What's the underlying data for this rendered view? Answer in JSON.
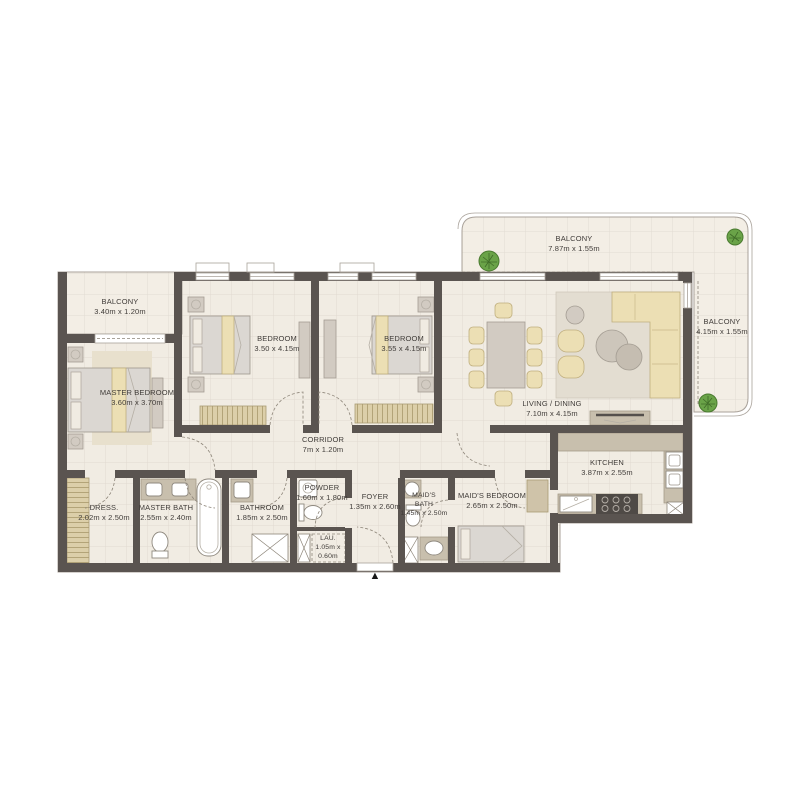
{
  "colors": {
    "wall": "#5a5450",
    "floor": "#f1ece3",
    "balcony_floor": "#f3eee5",
    "edge": "#a9a29a",
    "beige": "#ecdfb4",
    "beige_edge": "#bfae7e",
    "grey_furniture": "#d2cbc2",
    "counter": "#c8bfad",
    "stove": "#4f4a46",
    "tan_hatch": "#dccfa9",
    "plant": "#6aa348",
    "rug": "#e3ddd1",
    "text": "#403c39",
    "white_fixture": "#ffffff"
  },
  "rooms": {
    "balcony_left": {
      "name": "BALCONY",
      "dims": "3.40m x 1.20m"
    },
    "balcony_top": {
      "name": "BALCONY",
      "dims": "7.87m x 1.55m"
    },
    "balcony_right": {
      "name": "BALCONY",
      "dims": "4.15m x 1.55m"
    },
    "master_bedroom": {
      "name": "MASTER BEDROOM",
      "dims": "3.60m x 3.70m"
    },
    "bedroom_1": {
      "name": "BEDROOM",
      "dims": "3.50 x 4.15m"
    },
    "bedroom_2": {
      "name": "BEDROOM",
      "dims": "3.55 x 4.15m"
    },
    "living_dining": {
      "name": "LIVING / DINING",
      "dims": "7.10m x 4.15m"
    },
    "kitchen": {
      "name": "KITCHEN",
      "dims": "3.87m x 2.55m"
    },
    "corridor": {
      "name": "CORRIDOR",
      "dims": "7m x 1.20m"
    },
    "dress": {
      "name": "DRESS.",
      "dims": "2.02m x 2.50m"
    },
    "master_bath": {
      "name": "MASTER BATH",
      "dims": "2.55m x 2.40m"
    },
    "bathroom": {
      "name": "BATHROOM",
      "dims": "1.85m x 2.50m"
    },
    "powder": {
      "name": "POWDER",
      "dims": "1.60m x 1.80m"
    },
    "laundry": {
      "name": "LAU.",
      "dims_line1": "1.05m x",
      "dims_line2": "0.60m"
    },
    "foyer": {
      "name": "FOYER",
      "dims": "1.35m x 2.60m"
    },
    "maids_bath": {
      "name_line1": "MAID'S",
      "name_line2": "BATH",
      "dims": "1.45m x 2.50m"
    },
    "maids_bedroom": {
      "name": "MAID'S BEDROOM",
      "dims": "2.65m x 2.50m"
    }
  },
  "entrance": {
    "symbol": "▲"
  }
}
